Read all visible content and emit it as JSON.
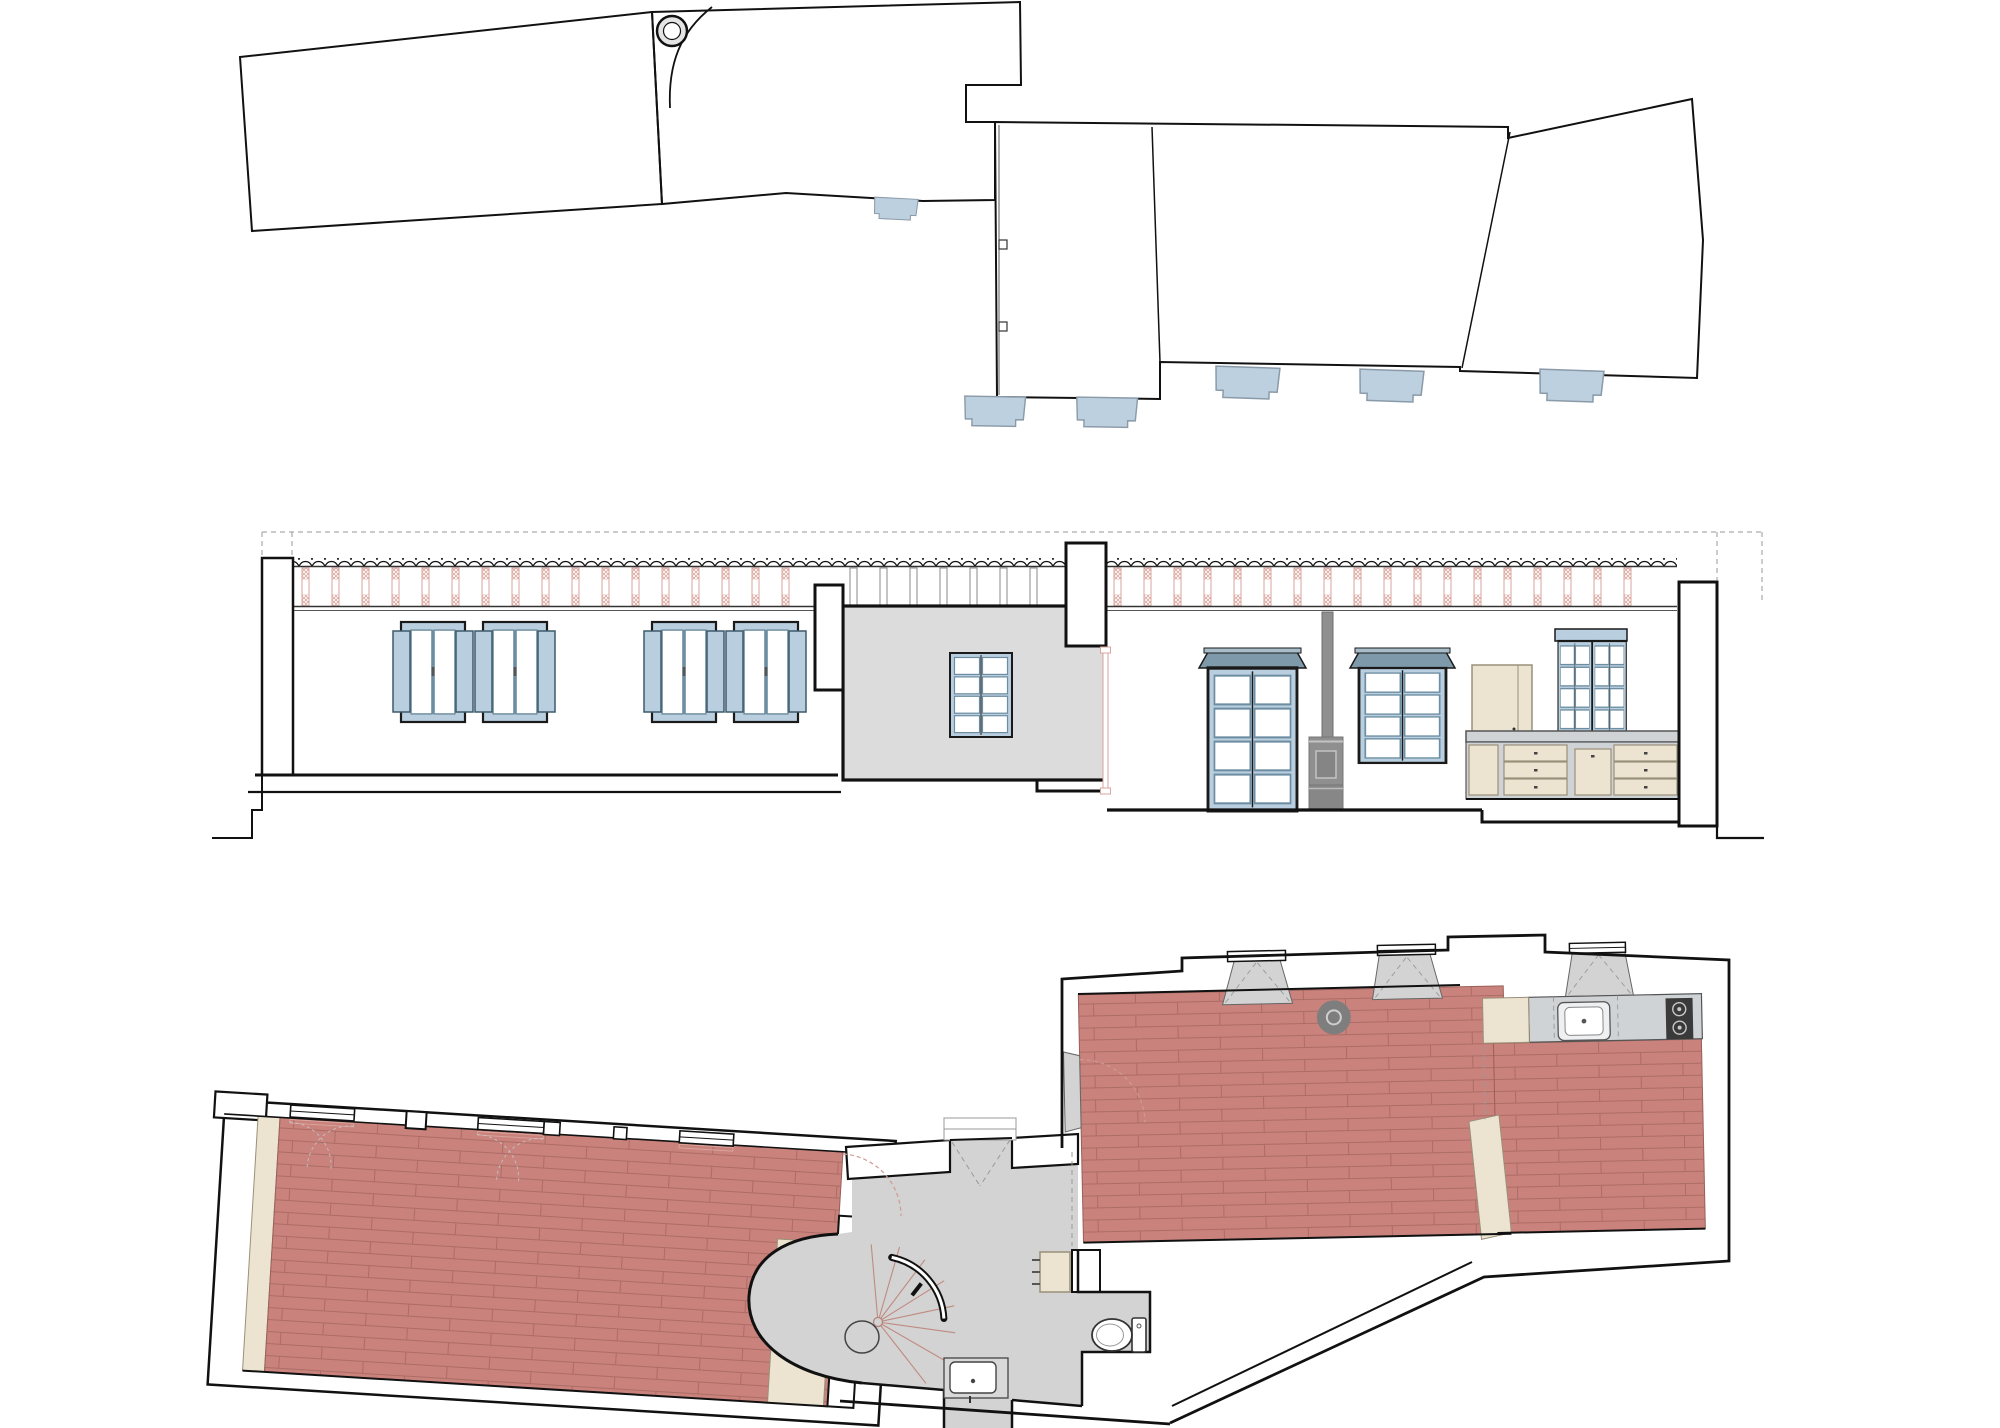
{
  "sheet": {
    "description": "architectural drawing sheet, no text labels visible",
    "drawings": [
      {
        "id": "roof-plan",
        "label": "roof plan"
      },
      {
        "id": "section-elevation",
        "label": "sectional elevation"
      },
      {
        "id": "floor-plan",
        "label": "floor plan"
      }
    ]
  },
  "colors": {
    "paper": "#ffffff",
    "ink": "#111111",
    "roofHatch": "#2e2e2e",
    "skylightBlue": "#bdd0e0",
    "skylightEdge": "#8a9aa8",
    "windowBlue": "#b9cedf",
    "windowFrameDark": "#1a1a1a",
    "sashBlue": "#6d8ea2",
    "shutterEdge": "#3d5a6b",
    "corniceBlue": "#7e99aa",
    "rafterPink": "#d9a59c",
    "pinkHatchLine": "#dba79e",
    "tileFloorRed": "#c9827c",
    "tileJointRed": "#ad6c66",
    "cream": "#ece4d0",
    "creamEdge": "#9a9079",
    "sectionGray": "#dcdcdc",
    "floorGray": "#d3d3d3",
    "counterGray": "#cfd3d6",
    "stoveGray": "#8f8f8f",
    "stoveDark": "#3a3a3a",
    "dashGray": "#999999",
    "swingPink": "#cf9a92"
  },
  "fixtures": [
    "chimney",
    "skylight-awning",
    "shuttered-window",
    "glazed-door",
    "wood-stove",
    "stove-pipe",
    "kitchen-upper-cabinet",
    "glazed-hutch",
    "kitchen-drawers",
    "spiral-staircase",
    "toilet",
    "washbasin",
    "kitchen-sink",
    "cooktop",
    "radiator",
    "entrance-porch",
    "floor-stove"
  ],
  "repeats": [
    {
      "host": "rafters-left",
      "ref": "rafter-pink",
      "x0": 302,
      "x1": 800,
      "dx": 30,
      "y": 568
    },
    {
      "host": "rafters-mid",
      "ref": "rafter-plain",
      "x0": 850,
      "x1": 1052,
      "dx": 30,
      "y": 568
    },
    {
      "host": "rafters-right",
      "ref": "rafter-pink",
      "x0": 1114,
      "x1": 1652,
      "dx": 30,
      "y": 568
    },
    {
      "host": "shuttered-windows",
      "ref": "shuttered-window",
      "items": [
        [
          393,
          622
        ],
        [
          475,
          622
        ],
        [
          644,
          622
        ],
        [
          726,
          622
        ]
      ]
    },
    {
      "host": "roof-awnings",
      "ref": "awning-tab",
      "items": [
        [
          872,
          197,
          0.68,
          3
        ],
        [
          961,
          396,
          0.95,
          1
        ],
        [
          1073,
          397,
          0.95,
          1
        ],
        [
          1212,
          366,
          1,
          2
        ],
        [
          1356,
          369,
          1,
          2
        ],
        [
          1536,
          369,
          1,
          2
        ]
      ]
    },
    {
      "host": "stair-radials",
      "ref": "stair-radial",
      "items": [
        [
          878,
          1322,
          1,
          -95
        ],
        [
          878,
          1322,
          1,
          -74
        ],
        [
          878,
          1322,
          1,
          -53
        ],
        [
          878,
          1322,
          1,
          -32
        ],
        [
          878,
          1322,
          1,
          -12
        ],
        [
          878,
          1322,
          1,
          8
        ],
        [
          878,
          1322,
          1,
          30
        ],
        [
          878,
          1322,
          1,
          52
        ]
      ]
    }
  ]
}
